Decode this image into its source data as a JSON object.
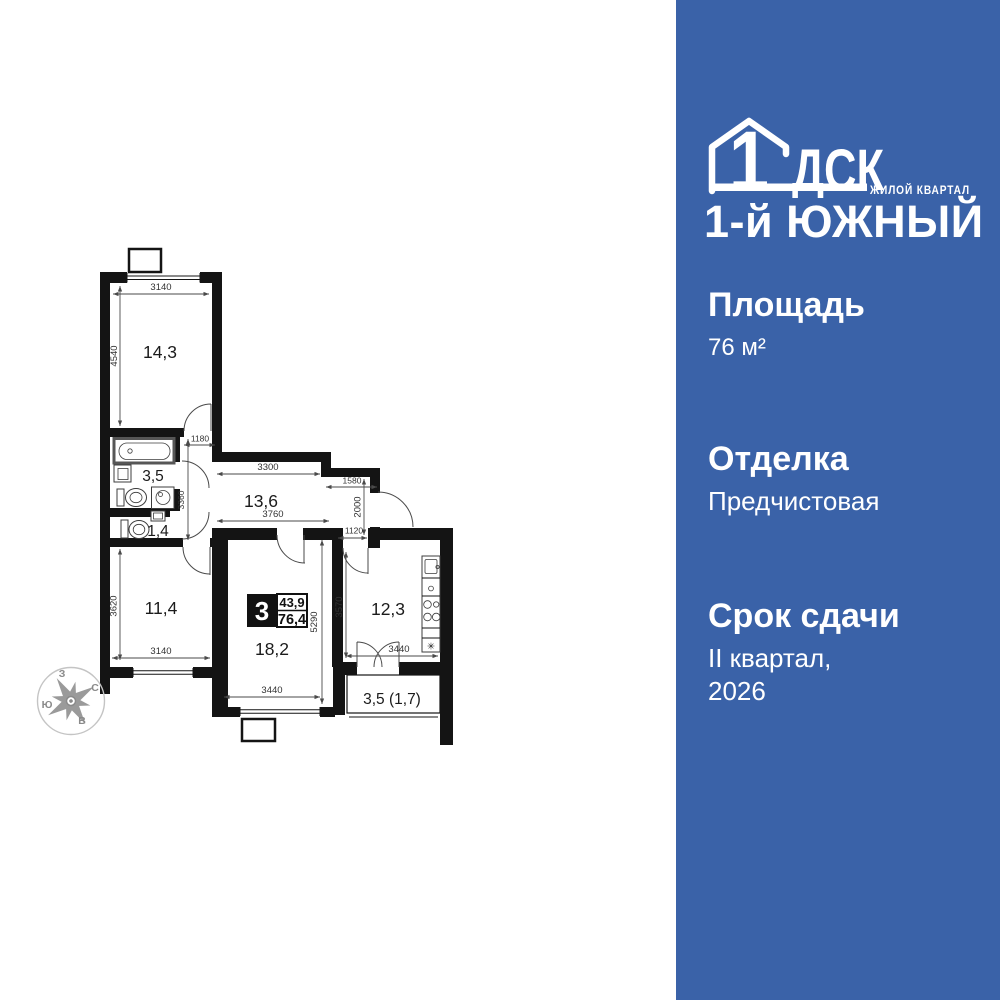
{
  "brand": {
    "logo_number": "1",
    "logo_letters": "ДСК",
    "logo_tagline": "ЖИЛОЙ КВАРТАЛ",
    "project_name": "1-й ЮЖНЫЙ"
  },
  "panel": {
    "bg": "#3a62a8",
    "area_label": "Площадь",
    "area_value": "76 м²",
    "finish_label": "Отделка",
    "finish_value": "Предчистовая",
    "deadline_label": "Срок сдачи",
    "deadline_line1": "II квартал,",
    "deadline_line2": "2026"
  },
  "plan": {
    "badge": {
      "rooms": "3",
      "living_area": "43,9",
      "total_area": "76,4"
    },
    "labels": {
      "room1": "14,3",
      "bathroom": "3,5",
      "wc": "1,4",
      "hallway": "13,6",
      "room2": "11,4",
      "living": "18,2",
      "kitchen": "12,3",
      "balcony": "3,5 (1,7)"
    },
    "dims": {
      "room1_width": "3140",
      "room1_height": "4540",
      "nook_width": "1180",
      "hall_width": "3300",
      "hall_niche": "1580",
      "hall_height": "2000",
      "hall_lower_width": "3760",
      "kitchen_door": "1120",
      "bath_block_height": "3360",
      "room2_height": "3620",
      "room2_width": "3140",
      "living_height": "5290",
      "living_width": "3440",
      "kitchen_height": "3570",
      "kitchen_width": "3440"
    },
    "compass": {
      "north": "С",
      "south": "Ю",
      "west": "З",
      "east": "В"
    }
  }
}
